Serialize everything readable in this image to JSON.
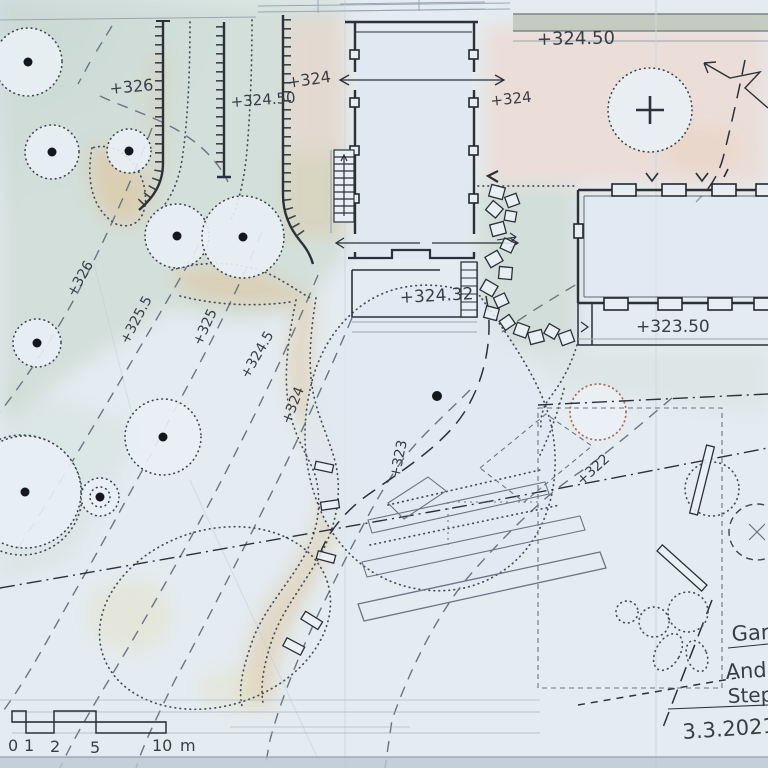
{
  "plan": {
    "title_block": {
      "line1": "Gart",
      "line2": "Andr",
      "line3": "Step",
      "date": "3.3.2021"
    },
    "elevations": {
      "street_terrace": "+324.50",
      "upper_lawn": "+326",
      "ramp_left": "+324.50",
      "ramp_right": "+324",
      "house_east": "+324",
      "house_terrace": "+324.32",
      "barn_terrace": "+323.50"
    },
    "contours": [
      {
        "label": "+326"
      },
      {
        "label": "+325.5"
      },
      {
        "label": "+325"
      },
      {
        "label": "+324.5"
      },
      {
        "label": "+324"
      },
      {
        "label": "+323"
      },
      {
        "label": "+322"
      }
    ],
    "scale_bar": {
      "t0": "0",
      "t1": "1",
      "t2": "2",
      "t5": "5",
      "t10": "10",
      "unit": "m"
    },
    "colors": {
      "paper": "#e4ecf1",
      "lawn_green": "#c5d6c9",
      "terrace_pink": "#f0d4c8",
      "path_tan": "#dfc49e",
      "ink": "#2b3138",
      "pencil": "#6b7580",
      "red_tree": "#b06a55"
    }
  }
}
